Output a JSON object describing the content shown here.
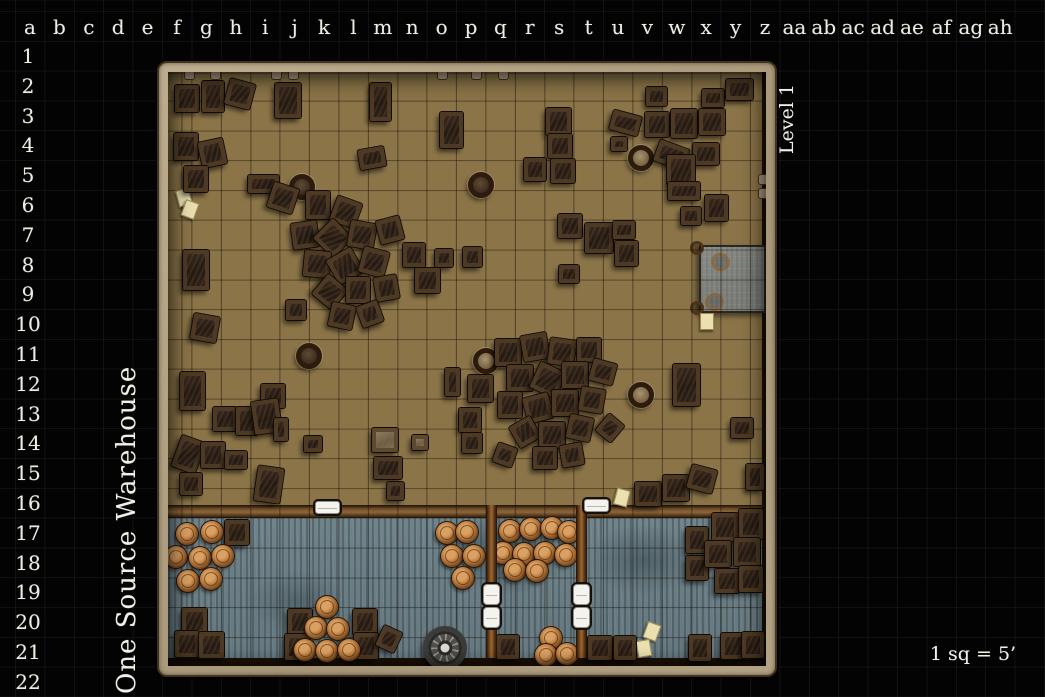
{
  "title": {
    "map_name": "One Source Warehouse",
    "level_label": "Level 1",
    "scale_label": "1 sq = 5’"
  },
  "grid": {
    "column_labels": [
      "a",
      "b",
      "c",
      "d",
      "e",
      "f",
      "g",
      "h",
      "i",
      "j",
      "k",
      "l",
      "m",
      "n",
      "o",
      "p",
      "q",
      "r",
      "s",
      "t",
      "u",
      "v",
      "w",
      "x",
      "y",
      "z",
      "aa",
      "ab",
      "ac",
      "ad",
      "ae",
      "af",
      "ag",
      "ah"
    ],
    "row_labels": [
      "1",
      "2",
      "3",
      "4",
      "5",
      "6",
      "7",
      "8",
      "9",
      "10",
      "11",
      "12",
      "13",
      "14",
      "15",
      "16",
      "17",
      "18",
      "19",
      "20",
      "21",
      "22"
    ]
  },
  "colors": {
    "background": "#030303",
    "grid_line": "rgba(255,255,255,0.05)",
    "label_text": "#efece3",
    "wall_tan": "#b2a084",
    "warehouse_floor": "#8b7448",
    "dock_floor": "#6e8087",
    "crate_brown": "#39291f",
    "crate_frame": "#4e3a24",
    "barrel_top": "#b5773b",
    "divider_wood": "#9c6831",
    "door_white": "#f4f3ee",
    "platform_gray": "#80837e",
    "paper": "#ece0b0"
  },
  "map": {
    "crates": [
      [
        187,
        98,
        24,
        27,
        0
      ],
      [
        213,
        96,
        22,
        31,
        0
      ],
      [
        240,
        94,
        26,
        26,
        15
      ],
      [
        288,
        100,
        26,
        35,
        0
      ],
      [
        186,
        146,
        24,
        27,
        0
      ],
      [
        212,
        153,
        25,
        26,
        -12
      ],
      [
        196,
        179,
        24,
        26,
        0
      ],
      [
        263,
        184,
        31,
        18,
        0
      ],
      [
        283,
        198,
        26,
        26,
        18
      ],
      [
        196,
        270,
        26,
        40,
        0
      ],
      [
        205,
        328,
        26,
        26,
        10
      ],
      [
        380,
        102,
        21,
        38,
        0
      ],
      [
        372,
        158,
        26,
        20,
        -10
      ],
      [
        451,
        130,
        23,
        36,
        0
      ],
      [
        558,
        121,
        25,
        27,
        0
      ],
      [
        560,
        146,
        24,
        24,
        0
      ],
      [
        535,
        169,
        22,
        23,
        0
      ],
      [
        563,
        171,
        24,
        24,
        0
      ],
      [
        625,
        123,
        29,
        20,
        15
      ],
      [
        619,
        144,
        16,
        14,
        0
      ],
      [
        656,
        96,
        21,
        19,
        0
      ],
      [
        713,
        98,
        22,
        18,
        0
      ],
      [
        739,
        89,
        27,
        21,
        0
      ],
      [
        657,
        124,
        24,
        25,
        0
      ],
      [
        684,
        123,
        26,
        29,
        0
      ],
      [
        712,
        122,
        26,
        26,
        0
      ],
      [
        671,
        155,
        31,
        22,
        20
      ],
      [
        706,
        154,
        26,
        22,
        0
      ],
      [
        681,
        170,
        28,
        30,
        0
      ],
      [
        684,
        191,
        32,
        18,
        0
      ],
      [
        716,
        208,
        23,
        26,
        0
      ],
      [
        691,
        216,
        20,
        18,
        0
      ],
      [
        570,
        226,
        24,
        24,
        0
      ],
      [
        599,
        238,
        28,
        30,
        0
      ],
      [
        624,
        230,
        22,
        18,
        0
      ],
      [
        626,
        253,
        23,
        25,
        0
      ],
      [
        569,
        274,
        20,
        18,
        0
      ],
      [
        318,
        205,
        24,
        28,
        0
      ],
      [
        346,
        212,
        26,
        26,
        20
      ],
      [
        305,
        235,
        26,
        26,
        -8
      ],
      [
        333,
        238,
        28,
        28,
        45
      ],
      [
        362,
        235,
        26,
        26,
        10
      ],
      [
        390,
        230,
        24,
        24,
        -15
      ],
      [
        317,
        264,
        26,
        26,
        5
      ],
      [
        345,
        266,
        28,
        28,
        -30
      ],
      [
        374,
        262,
        26,
        26,
        15
      ],
      [
        414,
        255,
        22,
        24,
        0
      ],
      [
        330,
        292,
        26,
        26,
        40
      ],
      [
        358,
        290,
        24,
        26,
        0
      ],
      [
        386,
        288,
        23,
        24,
        -10
      ],
      [
        342,
        316,
        24,
        24,
        12
      ],
      [
        370,
        314,
        22,
        22,
        -20
      ],
      [
        296,
        310,
        20,
        20,
        0
      ],
      [
        444,
        258,
        18,
        18,
        0
      ],
      [
        427,
        280,
        25,
        25,
        0
      ],
      [
        472,
        257,
        19,
        20,
        0
      ],
      [
        452,
        382,
        15,
        28,
        0
      ],
      [
        480,
        388,
        25,
        27,
        0
      ],
      [
        470,
        420,
        22,
        24,
        0
      ],
      [
        472,
        443,
        20,
        20,
        0
      ],
      [
        508,
        352,
        26,
        27,
        0
      ],
      [
        535,
        347,
        26,
        26,
        -10
      ],
      [
        562,
        352,
        26,
        26,
        8
      ],
      [
        589,
        350,
        24,
        24,
        0
      ],
      [
        520,
        378,
        26,
        26,
        0
      ],
      [
        548,
        380,
        28,
        28,
        25
      ],
      [
        575,
        375,
        26,
        26,
        0
      ],
      [
        603,
        372,
        24,
        22,
        15
      ],
      [
        510,
        405,
        24,
        26,
        0
      ],
      [
        538,
        408,
        26,
        26,
        -15
      ],
      [
        565,
        403,
        26,
        26,
        0
      ],
      [
        592,
        400,
        24,
        24,
        10
      ],
      [
        525,
        432,
        24,
        24,
        -30
      ],
      [
        552,
        435,
        26,
        26,
        0
      ],
      [
        580,
        428,
        24,
        24,
        12
      ],
      [
        545,
        458,
        24,
        22,
        0
      ],
      [
        572,
        455,
        22,
        22,
        -10
      ],
      [
        610,
        428,
        20,
        22,
        40
      ],
      [
        505,
        455,
        20,
        20,
        20
      ],
      [
        686,
        385,
        27,
        42,
        0
      ],
      [
        742,
        428,
        22,
        20,
        0
      ],
      [
        648,
        494,
        26,
        24,
        0
      ],
      [
        676,
        488,
        26,
        26,
        0
      ],
      [
        702,
        479,
        26,
        24,
        15
      ],
      [
        755,
        477,
        18,
        26,
        0
      ],
      [
        192,
        391,
        25,
        38,
        0
      ],
      [
        273,
        396,
        24,
        24,
        0
      ],
      [
        225,
        419,
        24,
        24,
        0
      ],
      [
        247,
        421,
        22,
        28,
        0
      ],
      [
        266,
        416,
        27,
        33,
        -8
      ],
      [
        281,
        429,
        14,
        23,
        0
      ],
      [
        188,
        454,
        25,
        33,
        20
      ],
      [
        213,
        455,
        24,
        26,
        0
      ],
      [
        236,
        460,
        22,
        18,
        0
      ],
      [
        191,
        484,
        22,
        22,
        0
      ],
      [
        269,
        484,
        26,
        35,
        8
      ],
      [
        313,
        444,
        18,
        16,
        0
      ],
      [
        385,
        440,
        26,
        24,
        0,
        1
      ],
      [
        420,
        442,
        16,
        15,
        0,
        1
      ],
      [
        388,
        468,
        28,
        22,
        0
      ],
      [
        395,
        491,
        17,
        18,
        0
      ],
      [
        237,
        532,
        24,
        25,
        0
      ],
      [
        194,
        621,
        25,
        26,
        0
      ],
      [
        187,
        644,
        24,
        26,
        0
      ],
      [
        211,
        645,
        25,
        26,
        0
      ],
      [
        300,
        622,
        24,
        26,
        0
      ],
      [
        297,
        647,
        25,
        26,
        0
      ],
      [
        365,
        622,
        24,
        26,
        0
      ],
      [
        366,
        646,
        24,
        26,
        0
      ],
      [
        389,
        639,
        20,
        22,
        25
      ],
      [
        508,
        647,
        22,
        24,
        0
      ],
      [
        600,
        648,
        24,
        24,
        0
      ],
      [
        625,
        648,
        22,
        24,
        0
      ],
      [
        700,
        648,
        22,
        26,
        0
      ],
      [
        733,
        646,
        24,
        26,
        0
      ],
      [
        753,
        645,
        22,
        26,
        0
      ],
      [
        697,
        540,
        22,
        26,
        0
      ],
      [
        697,
        568,
        22,
        24,
        0
      ],
      [
        725,
        527,
        26,
        28,
        0
      ],
      [
        751,
        524,
        24,
        30,
        0
      ],
      [
        718,
        554,
        26,
        26,
        0
      ],
      [
        747,
        552,
        26,
        28,
        0
      ],
      [
        727,
        581,
        24,
        24,
        0
      ],
      [
        751,
        579,
        24,
        26,
        0
      ]
    ],
    "vats": [
      [
        302,
        187,
        "dark"
      ],
      [
        481,
        185,
        "dark"
      ],
      [
        641,
        158,
        "tan"
      ],
      [
        309,
        356,
        "dark"
      ],
      [
        486,
        361,
        "tan"
      ],
      [
        641,
        395,
        "tan"
      ]
    ],
    "barrels": [
      [
        187,
        534
      ],
      [
        212,
        532
      ],
      [
        176,
        557
      ],
      [
        200,
        558
      ],
      [
        223,
        556
      ],
      [
        188,
        581
      ],
      [
        211,
        579
      ],
      [
        447,
        533
      ],
      [
        467,
        532
      ],
      [
        452,
        556
      ],
      [
        474,
        556
      ],
      [
        463,
        578
      ],
      [
        327,
        607
      ],
      [
        316,
        628
      ],
      [
        338,
        629
      ],
      [
        305,
        650
      ],
      [
        327,
        651
      ],
      [
        349,
        650
      ],
      [
        510,
        531
      ],
      [
        531,
        529
      ],
      [
        552,
        528
      ],
      [
        569,
        532
      ],
      [
        503,
        553
      ],
      [
        524,
        554
      ],
      [
        545,
        553
      ],
      [
        566,
        555
      ],
      [
        515,
        570
      ],
      [
        537,
        571
      ],
      [
        551,
        638
      ],
      [
        546,
        655
      ],
      [
        567,
        654
      ]
    ],
    "papers": [
      [
        183,
        196,
        -15
      ],
      [
        189,
        208,
        20
      ],
      [
        621,
        496,
        15
      ],
      [
        651,
        630,
        20
      ],
      [
        643,
        647,
        -10
      ],
      [
        706,
        320,
        0
      ]
    ]
  }
}
